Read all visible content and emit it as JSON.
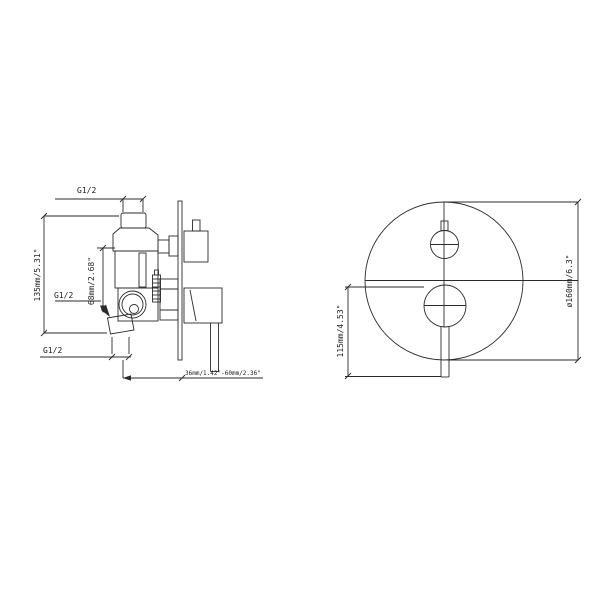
{
  "colors": {
    "background": "#ffffff",
    "line": "#2b2b2b",
    "text": "#1c1c1c"
  },
  "side_view": {
    "thread_top": "G1/2",
    "thread_mid": "G1/2",
    "thread_bottom": "G1/2",
    "dim_height": "135mm/5.31\"",
    "dim_offset": "68mm/2.68\"",
    "dim_depth_range": "36mm/1.42\"-60mm/2.36\""
  },
  "front_view": {
    "dim_diameter": "ø160mm/6.3\"",
    "dim_lever_height": "115mm/4.53\""
  }
}
